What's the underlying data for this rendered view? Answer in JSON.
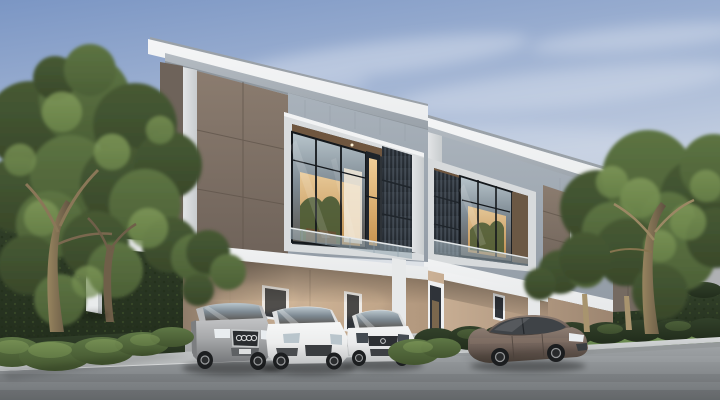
{
  "scene": {
    "type": "architectural-rendering",
    "description": "Exterior dusk rendering of two modern flat-roof two-storey townhouses with lit upper windows, carports with four parked cars, flanked by large trees, tall hedges and bushes along a concrete driveway and asphalt street under a pale blue sky with wispy clouds.",
    "time_of_day": "dusk",
    "objects": [
      {
        "name": "townhouse-left",
        "type": "building",
        "storeys": 2
      },
      {
        "name": "townhouse-right",
        "type": "building",
        "storeys": 2
      },
      {
        "name": "silver-suv",
        "type": "car",
        "color": "#a7a8aa"
      },
      {
        "name": "white-suv",
        "type": "car",
        "color": "#eceded"
      },
      {
        "name": "white-hatchback",
        "type": "car",
        "color": "#e9eaeb"
      },
      {
        "name": "bronze-sedan",
        "type": "car",
        "color": "#71625a"
      },
      {
        "name": "trees-left",
        "type": "vegetation"
      },
      {
        "name": "trees-right",
        "type": "vegetation"
      },
      {
        "name": "hedges",
        "type": "vegetation"
      },
      {
        "name": "street",
        "type": "road"
      },
      {
        "name": "driveway",
        "type": "pavement"
      }
    ]
  },
  "palette": {
    "sky_top": "#7b96c4",
    "sky_mid": "#b7c5dc",
    "sky_horizon": "#e7e9ea",
    "cloud": "#ffffff",
    "roof_fascia": "#eceeef",
    "roof_edge": "#9aa1a8",
    "soffit": "#b4bbc2",
    "wall_blue_gray": "#a9b2bb",
    "corner_white": "#e2e4e6",
    "panel_brown": "#8b7c6f",
    "side_panel_dark": "#6e635a",
    "window_warm": "#f0cd97",
    "window_glass": "#b9c6cd",
    "interior_wood": "#7d6148",
    "louver_dark": "#353c44",
    "balustrade_glass": "#b9c9d2",
    "slab_white": "#e7e9ea",
    "ground_wall_beige": "#cbb196",
    "ground_wall_shadow": "#8f7c6a",
    "door_dark": "#2f3339",
    "frame_white": "#eff0f1",
    "hedge_dark": "#32412a",
    "foliage_dark": "#475a34",
    "foliage_mid": "#5d7443",
    "foliage_light": "#849e5c",
    "trunk": "#97845f",
    "lawn": "#7e9b5c",
    "bush": "#5f7846",
    "sidewalk": "#c9cccd",
    "curb": "#d6d8d9",
    "road_top": "#a0a4a7",
    "road_bottom": "#6f7376",
    "car_silver": "#a7a8aa",
    "car_white": "#eceded",
    "car_white_hatch": "#e9eaeb",
    "car_bronze": "#71625a",
    "glass_dark": "#3c424a",
    "tire": "#1c1e20",
    "rim": "#939597",
    "headlight": "#e9edf0",
    "distant_roof": "#868c91",
    "distant_wall": "#b3b6b8"
  }
}
